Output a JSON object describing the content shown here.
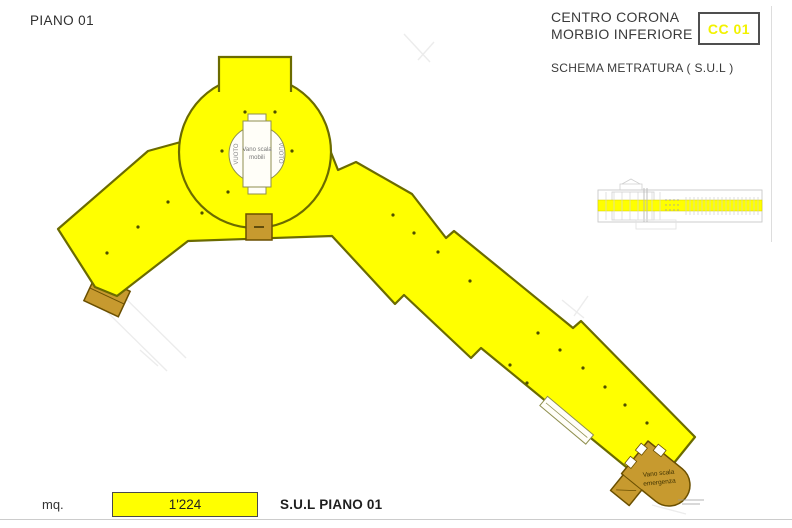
{
  "header": {
    "floor_title": "PIANO 01",
    "project_line1": "CENTRO CORONA",
    "project_line2": "MORBIO INFERIORE",
    "badge_code": "CC 01",
    "subtitle": "SCHEMA METRATURA ( S.U.L )"
  },
  "plan": {
    "vuoto_left": "VUOTO",
    "vuoto_right": "VUOTO",
    "central_stair_line1": "Vano scala",
    "central_stair_line2": "mobili",
    "emergency_stair_line1": "Vano scala",
    "emergency_stair_line2": "emergenza",
    "colors": {
      "floor_fill": "#FFFF00",
      "floor_stroke": "#6B6B00",
      "stair_fill": "#C79A2F",
      "stair_stroke": "#6A4F00",
      "minimap_highlight": "#FFFF00",
      "badge_text": "#F2F200"
    }
  },
  "footer": {
    "unit_label": "mq.",
    "area_value": "1'224",
    "area_label": "S.U.L PIANO 01",
    "value_box_fill": "#FFFF00"
  }
}
